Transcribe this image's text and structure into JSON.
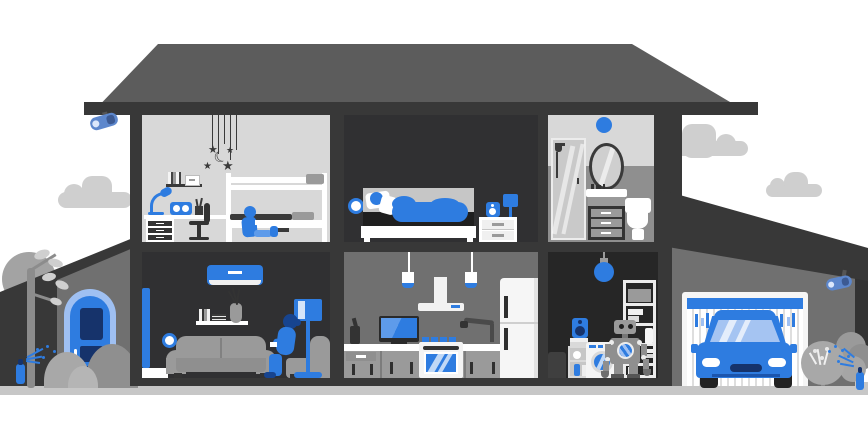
{
  "scene": {
    "title": "Smart home cutaway illustration",
    "palette": {
      "blue": "#2e7ce0",
      "blue_light": "#9fc0f2",
      "blue_mid": "#5e9bea",
      "blue_dark": "#16336b",
      "camera": "#5d87cc",
      "roof": "#5c5c5c",
      "wall": "#383838",
      "wall_deep": "#333333",
      "wall_mid": "#707070",
      "room_light": "#d8d8d8",
      "room_dark": "#303032",
      "room_darker": "#262626",
      "bath_lower": "#8f8f8f",
      "furniture": "#9a9a9a",
      "ground": "#c7c7c7",
      "cloud": "#cfcfcf",
      "white": "#ffffff"
    },
    "icons": {
      "star": "★",
      "moon": "☾"
    },
    "exterior": {
      "objects": [
        "cloud-left",
        "cloud-right-1",
        "cloud-right-2",
        "tree",
        "bushes",
        "porch-roof",
        "front-door",
        "security-camera-left",
        "security-camera-right",
        "sprinkler-left",
        "sprinkler-right",
        "garden-bush",
        "ground"
      ]
    },
    "rooms": [
      {
        "id": "kids-room",
        "objects": [
          "star-mobile",
          "wall-shelf-books",
          "desk-lamp",
          "smart-speaker",
          "desk",
          "office-chair",
          "bunk-bed",
          "child-with-tablet"
        ]
      },
      {
        "id": "bedroom",
        "objects": [
          "smart-wall-sensor",
          "bed",
          "sleeping-person",
          "nightstand",
          "smart-speaker",
          "table-lamp"
        ]
      },
      {
        "id": "bathroom",
        "objects": [
          "smart-ceiling-light",
          "shower",
          "mirror",
          "vanity-cabinet",
          "toilet"
        ]
      },
      {
        "id": "living-room",
        "objects": [
          "window-curtain",
          "air-conditioner",
          "wall-shelf",
          "smart-wall-sensor",
          "sofa",
          "armchair",
          "floor-lamp",
          "woman-reading-phone",
          "side-table"
        ]
      },
      {
        "id": "kitchen",
        "objects": [
          "pendant-lights",
          "range-hood",
          "tv",
          "blender",
          "faucet",
          "counter-cabinets",
          "smart-oven",
          "fridge"
        ]
      },
      {
        "id": "utility-room",
        "objects": [
          "smart-bulb",
          "storage-shelf",
          "washing-machine",
          "robot-assistant",
          "laundry-shelf",
          "smart-speaker",
          "trash-bin"
        ]
      },
      {
        "id": "garage",
        "objects": [
          "garage-door",
          "car",
          "security-camera"
        ]
      }
    ]
  }
}
